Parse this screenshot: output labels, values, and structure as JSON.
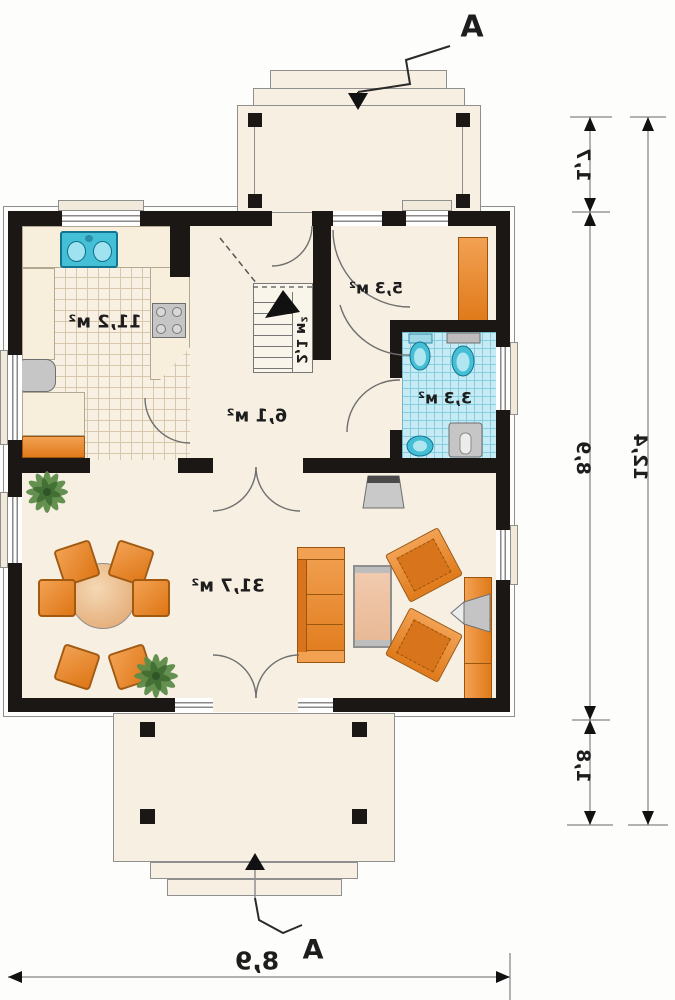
{
  "title": "house-ground-floor-plan",
  "rooms": {
    "kitchen": "11,2 м²",
    "bedroom": "5,3 м²",
    "stairs": "2,1 м²",
    "hall": "6,1 м²",
    "bathroom": "3,3 м²",
    "living_room": "31,7 м²"
  },
  "dimensions": {
    "right_porch_depth": "1,7",
    "right_house_depth": "8,9",
    "right_terrace_depth": "1,8",
    "right_total_depth": "12,4",
    "bottom_house_width": "8,9"
  },
  "section_markers": {
    "top": "A",
    "bottom": "A"
  },
  "colors": {
    "wall": "#1a1715",
    "floor_cream": "#F6EFE2",
    "furniture_orange": "#E8862B",
    "fixture_teal": "#45BFD6",
    "bath_tile_blue": "#C6EBF5",
    "appliance_gray": "#C6C6C6",
    "plant_green": "#5E8C49",
    "dimension_line": "#999999"
  }
}
